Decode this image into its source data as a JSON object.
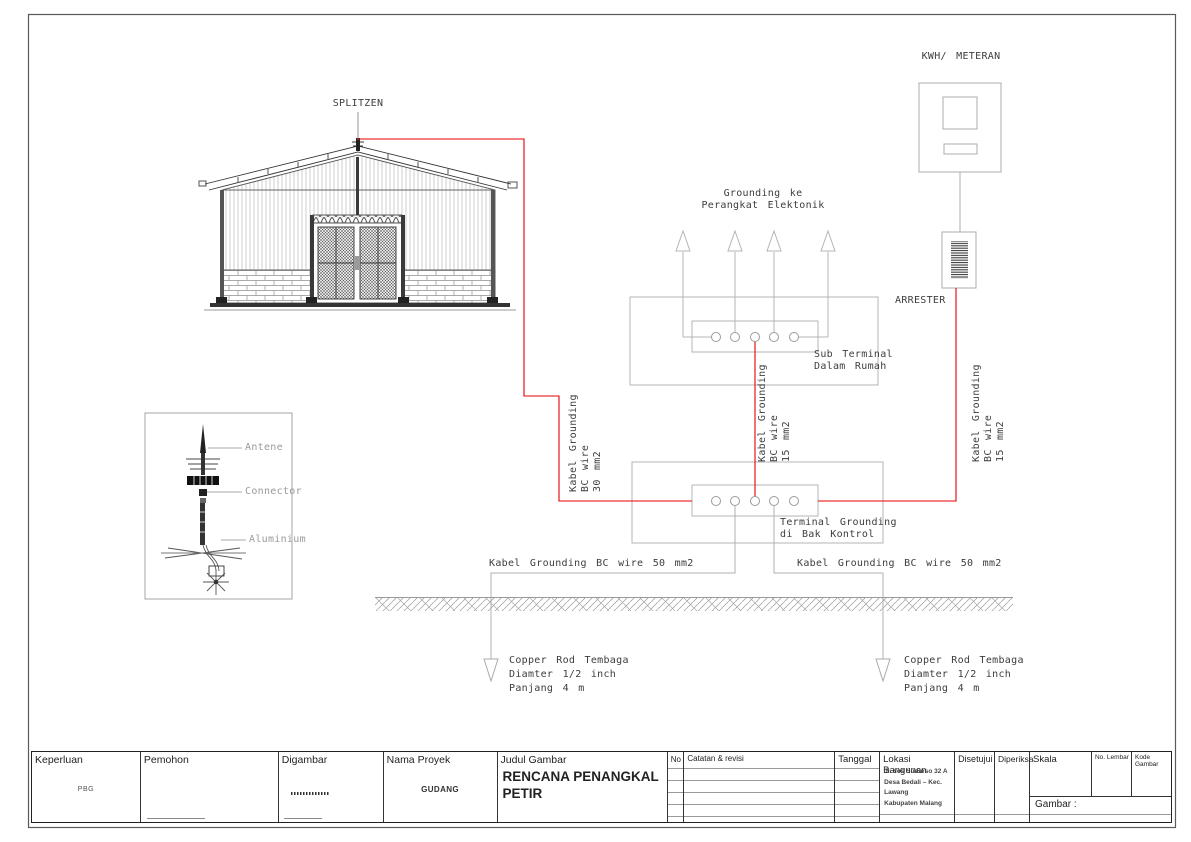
{
  "diagram": {
    "splitzen_label": "SPLITZEN",
    "kwh_label": "KWH/ METERAN",
    "arrester_label": "ARRESTER",
    "grounding_ke": {
      "line1": "Grounding ke",
      "line2": "Perangkat Elektonik"
    },
    "sub_terminal": {
      "line1": "Sub Terminal",
      "line2": "Dalam Rumah"
    },
    "terminal_grounding": {
      "line1": "Terminal Grounding",
      "line2": "di Bak Kontrol"
    },
    "cable_left": {
      "line1": "Kabel Grounding",
      "line2": "BC wire",
      "line3": "30 mm2"
    },
    "cable_mid": {
      "line1": "Kabel Grounding",
      "line2": "BC wire",
      "line3": "15 mm2"
    },
    "cable_right": {
      "line1": "Kabel Grounding",
      "line2": "BC wire",
      "line3": "15 mm2"
    },
    "cable_50_left": "Kabel Grounding BC wire 50 mm2",
    "cable_50_right": "Kabel Grounding BC wire 50 mm2",
    "copper_rod_left": {
      "line1": "Copper Rod Tembaga",
      "line2": "Diamter 1/2 inch",
      "line3": "Panjang 4 m"
    },
    "copper_rod_right": {
      "line1": "Copper Rod Tembaga",
      "line2": "Diamter 1/2 inch",
      "line3": "Panjang 4 m"
    },
    "rod_detail": {
      "antene": "Antene",
      "connector": "Connector",
      "aluminium": "Aluminium"
    },
    "colors": {
      "cable_red": "#e60000",
      "line_gray": "#b5b5b5",
      "building_ink": "#3f3f3f"
    }
  },
  "title_block": {
    "keperluan": {
      "label": "Keperluan",
      "value": "PBG"
    },
    "pemohon": {
      "label": "Pemohon"
    },
    "digambar": {
      "label": "Digambar"
    },
    "nama_proyek": {
      "label": "Nama Proyek",
      "value": "GUDANG"
    },
    "judul_gambar": {
      "label": "Judul Gambar",
      "value": "RENCANA PENANGKAL PETIR"
    },
    "no": {
      "label": "No"
    },
    "catatan": {
      "label": "Catatan & revisi"
    },
    "tanggal": {
      "label": "Tanggal"
    },
    "lokasi": {
      "label": "Lokasi Bangunan",
      "line1": "Jl. Yos Sudarso 32 A",
      "line2": "Desa Bedali – Kec.",
      "line3": "Lawang",
      "line4": "Kabupaten Malang"
    },
    "disetujui": {
      "label": "Disetujui"
    },
    "diperiksa": {
      "label": "Diperiksa"
    },
    "skala": {
      "label": "Skala",
      "gambar_label": "Gambar :"
    },
    "no_lembar": {
      "label": "No. Lembar"
    },
    "kode_gambar": {
      "label": "Kode Gambar"
    }
  }
}
